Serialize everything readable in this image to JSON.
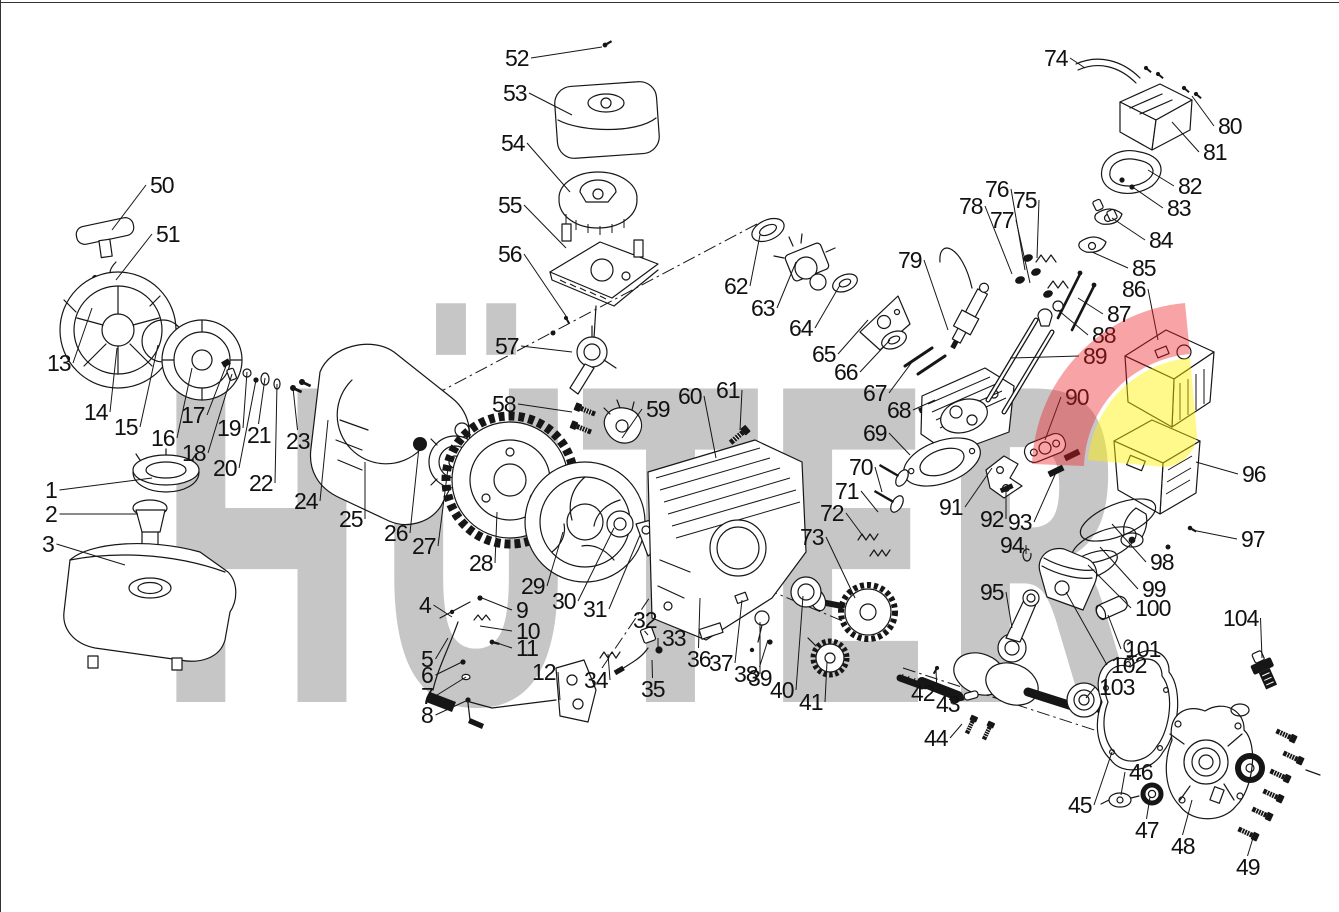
{
  "watermark": {
    "text": "HÜTER",
    "color": "#C6C6C6"
  },
  "logo": {
    "red": "#ED1C24",
    "yellow": "#FFF200",
    "red_opacity": 0.4,
    "yellow_opacity": 0.45
  },
  "diagram": {
    "kind": "engine exploded parts diagram",
    "part_numbers_min": 1,
    "part_numbers_max": 104
  },
  "parts": [
    {
      "n": 1,
      "l": [
        45,
        490
      ],
      "t": [
        152,
        478
      ]
    },
    {
      "n": 2,
      "l": [
        45,
        514
      ],
      "t": [
        138,
        514
      ]
    },
    {
      "n": 3,
      "l": [
        42,
        544
      ],
      "t": [
        125,
        565
      ]
    },
    {
      "n": 4,
      "l": [
        419,
        605
      ],
      "t": [
        452,
        617
      ]
    },
    {
      "n": 5,
      "l": [
        421,
        659
      ],
      "t": [
        448,
        638
      ]
    },
    {
      "n": 6,
      "l": [
        421,
        675
      ],
      "t": [
        462,
        662
      ]
    },
    {
      "n": 7,
      "l": [
        421,
        696
      ],
      "t": [
        466,
        677
      ]
    },
    {
      "n": 8,
      "l": [
        421,
        715
      ],
      "t": [
        468,
        700
      ]
    },
    {
      "n": 9,
      "l": [
        516,
        610
      ],
      "t": [
        482,
        598
      ]
    },
    {
      "n": 10,
      "l": [
        516,
        631
      ],
      "t": [
        480,
        626
      ]
    },
    {
      "n": 11,
      "l": [
        516,
        648
      ],
      "t": [
        494,
        642
      ]
    },
    {
      "n": 12,
      "l": [
        532,
        672
      ],
      "t": [
        560,
        700
      ]
    },
    {
      "n": 13,
      "l": [
        47,
        363
      ],
      "t": [
        92,
        308
      ]
    },
    {
      "n": 14,
      "l": [
        84,
        412
      ],
      "t": [
        117,
        348
      ]
    },
    {
      "n": 15,
      "l": [
        114,
        427
      ],
      "t": [
        158,
        345
      ]
    },
    {
      "n": 16,
      "l": [
        151,
        438
      ],
      "t": [
        192,
        368
      ]
    },
    {
      "n": 17,
      "l": [
        181,
        415
      ],
      "t": [
        226,
        366
      ]
    },
    {
      "n": 18,
      "l": [
        182,
        453
      ],
      "t": [
        232,
        374
      ]
    },
    {
      "n": 19,
      "l": [
        217,
        428
      ],
      "t": [
        247,
        372
      ]
    },
    {
      "n": 20,
      "l": [
        213,
        468
      ],
      "t": [
        256,
        380
      ]
    },
    {
      "n": 21,
      "l": [
        247,
        435
      ],
      "t": [
        265,
        378
      ]
    },
    {
      "n": 22,
      "l": [
        249,
        483
      ],
      "t": [
        277,
        384
      ]
    },
    {
      "n": 23,
      "l": [
        286,
        441
      ],
      "t": [
        293,
        388
      ]
    },
    {
      "n": 24,
      "l": [
        294,
        501
      ],
      "t": [
        328,
        420
      ]
    },
    {
      "n": 25,
      "l": [
        339,
        519
      ],
      "t": [
        365,
        462
      ]
    },
    {
      "n": 26,
      "l": [
        384,
        533
      ],
      "t": [
        419,
        447
      ]
    },
    {
      "n": 27,
      "l": [
        412,
        546
      ],
      "t": [
        448,
        468
      ]
    },
    {
      "n": 28,
      "l": [
        469,
        563
      ],
      "t": [
        497,
        512
      ]
    },
    {
      "n": 29,
      "l": [
        521,
        586
      ],
      "t": [
        563,
        532
      ]
    },
    {
      "n": 30,
      "l": [
        552,
        601
      ],
      "t": [
        614,
        528
      ]
    },
    {
      "n": 31,
      "l": [
        583,
        609
      ],
      "t": [
        640,
        535
      ]
    },
    {
      "n": 32,
      "l": [
        633,
        620
      ],
      "t": [
        648,
        635
      ]
    },
    {
      "n": 33,
      "l": [
        662,
        638
      ],
      "t": [
        658,
        650
      ]
    },
    {
      "n": 34,
      "l": [
        584,
        680
      ],
      "t": [
        608,
        654
      ]
    },
    {
      "n": 35,
      "l": [
        641,
        689
      ],
      "t": [
        652,
        660
      ]
    },
    {
      "n": 36,
      "l": [
        687,
        659
      ],
      "t": [
        700,
        598
      ]
    },
    {
      "n": 37,
      "l": [
        709,
        663
      ],
      "t": [
        742,
        600
      ]
    },
    {
      "n": 38,
      "l": [
        734,
        674
      ],
      "t": [
        760,
        622
      ]
    },
    {
      "n": 39,
      "l": [
        748,
        678
      ],
      "t": [
        768,
        640
      ]
    },
    {
      "n": 40,
      "l": [
        770,
        690
      ],
      "t": [
        803,
        596
      ]
    },
    {
      "n": 41,
      "l": [
        799,
        702
      ],
      "t": [
        827,
        662
      ]
    },
    {
      "n": 42,
      "l": [
        911,
        693
      ],
      "t": [
        936,
        670
      ]
    },
    {
      "n": 43,
      "l": [
        936,
        704
      ],
      "t": [
        958,
        700
      ]
    },
    {
      "n": 44,
      "l": [
        924,
        738
      ],
      "t": [
        962,
        724
      ]
    },
    {
      "n": 45,
      "l": [
        1068,
        805
      ],
      "t": [
        1112,
        752
      ]
    },
    {
      "n": 46,
      "l": [
        1129,
        772
      ],
      "t": [
        1121,
        795
      ]
    },
    {
      "n": 47,
      "l": [
        1135,
        830
      ],
      "t": [
        1150,
        797
      ]
    },
    {
      "n": 48,
      "l": [
        1171,
        846
      ],
      "t": [
        1192,
        800
      ]
    },
    {
      "n": 49,
      "l": [
        1236,
        867
      ],
      "t": [
        1253,
        838
      ]
    },
    {
      "n": 50,
      "l": [
        150,
        185
      ],
      "t": [
        112,
        230
      ]
    },
    {
      "n": 51,
      "l": [
        156,
        234
      ],
      "t": [
        116,
        280
      ]
    },
    {
      "n": 52,
      "l": [
        505,
        58
      ],
      "t": [
        602,
        47
      ]
    },
    {
      "n": 53,
      "l": [
        503,
        93
      ],
      "t": [
        572,
        115
      ]
    },
    {
      "n": 54,
      "l": [
        501,
        143
      ],
      "t": [
        570,
        192
      ]
    },
    {
      "n": 55,
      "l": [
        498,
        205
      ],
      "t": [
        566,
        248
      ]
    },
    {
      "n": 56,
      "l": [
        498,
        254
      ],
      "t": [
        566,
        316
      ]
    },
    {
      "n": 57,
      "l": [
        495,
        346
      ],
      "t": [
        572,
        352
      ]
    },
    {
      "n": 58,
      "l": [
        492,
        404
      ],
      "t": [
        572,
        412
      ]
    },
    {
      "n": 59,
      "l": [
        646,
        409
      ],
      "t": [
        622,
        438
      ]
    },
    {
      "n": 60,
      "l": [
        678,
        396
      ],
      "t": [
        716,
        458
      ]
    },
    {
      "n": 61,
      "l": [
        716,
        390
      ],
      "t": [
        740,
        430
      ]
    },
    {
      "n": 62,
      "l": [
        724,
        286
      ],
      "t": [
        760,
        235
      ]
    },
    {
      "n": 63,
      "l": [
        751,
        308
      ],
      "t": [
        796,
        262
      ]
    },
    {
      "n": 64,
      "l": [
        789,
        328
      ],
      "t": [
        840,
        285
      ]
    },
    {
      "n": 65,
      "l": [
        812,
        354
      ],
      "t": [
        868,
        320
      ]
    },
    {
      "n": 66,
      "l": [
        834,
        372
      ],
      "t": [
        890,
        340
      ]
    },
    {
      "n": 67,
      "l": [
        863,
        393
      ],
      "t": [
        915,
        358
      ]
    },
    {
      "n": 68,
      "l": [
        887,
        410
      ],
      "t": [
        935,
        400
      ]
    },
    {
      "n": 69,
      "l": [
        863,
        433
      ],
      "t": [
        910,
        455
      ]
    },
    {
      "n": 70,
      "l": [
        849,
        467
      ],
      "t": [
        882,
        492
      ]
    },
    {
      "n": 71,
      "l": [
        835,
        491
      ],
      "t": [
        878,
        512
      ]
    },
    {
      "n": 72,
      "l": [
        820,
        513
      ],
      "t": [
        866,
        540
      ]
    },
    {
      "n": 73,
      "l": [
        800,
        537
      ],
      "t": [
        855,
        598
      ]
    },
    {
      "n": 74,
      "l": [
        1044,
        58
      ],
      "t": [
        1085,
        68
      ]
    },
    {
      "n": 75,
      "l": [
        1013,
        200
      ],
      "t": [
        1037,
        258
      ]
    },
    {
      "n": 76,
      "l": [
        985,
        189
      ],
      "t": [
        1025,
        270
      ]
    },
    {
      "n": 77,
      "l": [
        990,
        220
      ],
      "t": [
        1030,
        283
      ]
    },
    {
      "n": 78,
      "l": [
        959,
        206
      ],
      "t": [
        1012,
        274
      ]
    },
    {
      "n": 79,
      "l": [
        898,
        260
      ],
      "t": [
        948,
        330
      ]
    },
    {
      "n": 80,
      "l": [
        1218,
        126
      ],
      "t": [
        1192,
        96
      ]
    },
    {
      "n": 81,
      "l": [
        1203,
        152
      ],
      "t": [
        1172,
        122
      ]
    },
    {
      "n": 82,
      "l": [
        1178,
        186
      ],
      "t": [
        1148,
        170
      ]
    },
    {
      "n": 83,
      "l": [
        1167,
        208
      ],
      "t": [
        1134,
        188
      ]
    },
    {
      "n": 84,
      "l": [
        1149,
        240
      ],
      "t": [
        1112,
        218
      ]
    },
    {
      "n": 85,
      "l": [
        1132,
        268
      ],
      "t": [
        1092,
        252
      ]
    },
    {
      "n": 86,
      "l": [
        1122,
        289
      ],
      "t": [
        1158,
        340
      ]
    },
    {
      "n": 87,
      "l": [
        1107,
        314
      ],
      "t": [
        1078,
        298
      ]
    },
    {
      "n": 88,
      "l": [
        1092,
        335
      ],
      "t": [
        1058,
        310
      ]
    },
    {
      "n": 89,
      "l": [
        1083,
        356
      ],
      "t": [
        1010,
        358
      ]
    },
    {
      "n": 90,
      "l": [
        1065,
        397
      ],
      "t": [
        1045,
        440
      ]
    },
    {
      "n": 91,
      "l": [
        939,
        507
      ],
      "t": [
        992,
        468
      ]
    },
    {
      "n": 92,
      "l": [
        980,
        519
      ],
      "t": [
        1006,
        492
      ]
    },
    {
      "n": 93,
      "l": [
        1008,
        522
      ],
      "t": [
        1058,
        468
      ]
    },
    {
      "n": 94,
      "l": [
        1000,
        545
      ],
      "t": [
        1026,
        554
      ]
    },
    {
      "n": 95,
      "l": [
        980,
        592
      ],
      "t": [
        1012,
        628
      ]
    },
    {
      "n": 96,
      "l": [
        1242,
        474
      ],
      "t": [
        1196,
        462
      ]
    },
    {
      "n": 97,
      "l": [
        1241,
        539
      ],
      "t": [
        1192,
        530
      ]
    },
    {
      "n": 98,
      "l": [
        1150,
        562
      ],
      "t": [
        1112,
        524
      ]
    },
    {
      "n": 99,
      "l": [
        1142,
        589
      ],
      "t": [
        1100,
        547
      ]
    },
    {
      "n": 100,
      "l": [
        1135,
        608
      ],
      "t": [
        1088,
        565
      ]
    },
    {
      "n": 101,
      "l": [
        1125,
        649
      ],
      "t": [
        1108,
        615
      ]
    },
    {
      "n": 102,
      "l": [
        1111,
        665
      ],
      "t": [
        1066,
        592
      ]
    },
    {
      "n": 103,
      "l": [
        1099,
        687
      ],
      "t": [
        1086,
        698
      ]
    },
    {
      "n": 104,
      "l": [
        1223,
        618
      ],
      "t": [
        1262,
        658
      ]
    }
  ]
}
